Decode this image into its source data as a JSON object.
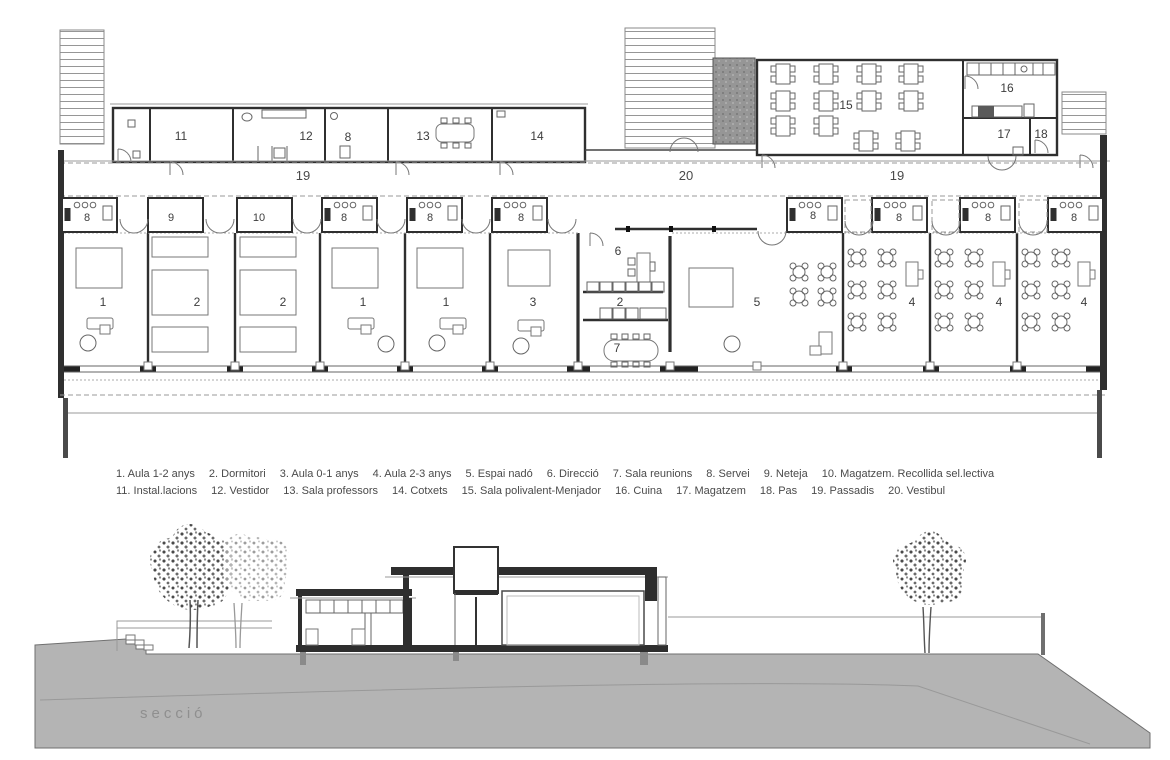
{
  "legend": {
    "row1": [
      "1. Aula 1-2 anys",
      "2. Dormitori",
      "3. Aula 0-1 anys",
      "4. Aula 2-3 anys",
      "5. Espai nadó",
      "6. Direcció",
      "7. Sala reunions",
      "8. Servei",
      "9. Neteja",
      "10. Magatzem. Recollida sel.lectiva"
    ],
    "row2": [
      "11. Instal.lacions",
      "12. Vestidor",
      "13. Sala professors",
      "14. Cotxets",
      "15. Sala polivalent-Menjador",
      "16. Cuina",
      "17. Magatzem",
      "18. Pas",
      "19. Passadis",
      "20. Vestibul"
    ]
  },
  "plan": {
    "room_labels": [
      {
        "text": "11",
        "x": 181,
        "y": 140
      },
      {
        "text": "12",
        "x": 306,
        "y": 140
      },
      {
        "text": "8",
        "x": 348,
        "y": 141
      },
      {
        "text": "13",
        "x": 423,
        "y": 140
      },
      {
        "text": "14",
        "x": 537,
        "y": 140
      },
      {
        "text": "15",
        "x": 846,
        "y": 109
      },
      {
        "text": "16",
        "x": 1007,
        "y": 92
      },
      {
        "text": "17",
        "x": 1004,
        "y": 138
      },
      {
        "text": "18",
        "x": 1041,
        "y": 138
      },
      {
        "text": "1",
        "x": 103,
        "y": 306
      },
      {
        "text": "2",
        "x": 197,
        "y": 306
      },
      {
        "text": "2",
        "x": 283,
        "y": 306
      },
      {
        "text": "1",
        "x": 363,
        "y": 306
      },
      {
        "text": "1",
        "x": 446,
        "y": 306
      },
      {
        "text": "3",
        "x": 533,
        "y": 306
      },
      {
        "text": "6",
        "x": 618,
        "y": 255
      },
      {
        "text": "2",
        "x": 620,
        "y": 306
      },
      {
        "text": "7",
        "x": 617,
        "y": 352
      },
      {
        "text": "5",
        "x": 757,
        "y": 306
      },
      {
        "text": "4",
        "x": 912,
        "y": 306
      },
      {
        "text": "4",
        "x": 999,
        "y": 306
      },
      {
        "text": "4",
        "x": 1084,
        "y": 306
      }
    ],
    "small_room_labels": [
      {
        "text": "8",
        "x": 87,
        "y": 221
      },
      {
        "text": "9",
        "x": 171,
        "y": 221
      },
      {
        "text": "10",
        "x": 259,
        "y": 221
      },
      {
        "text": "8",
        "x": 344,
        "y": 221
      },
      {
        "text": "8",
        "x": 430,
        "y": 221
      },
      {
        "text": "8",
        "x": 521,
        "y": 221
      },
      {
        "text": "8",
        "x": 813,
        "y": 219
      },
      {
        "text": "8",
        "x": 899,
        "y": 221
      },
      {
        "text": "8",
        "x": 988,
        "y": 221
      },
      {
        "text": "8",
        "x": 1074,
        "y": 221
      }
    ],
    "corridor_labels": [
      {
        "text": "19",
        "x": 303,
        "y": 180
      },
      {
        "text": "20",
        "x": 686,
        "y": 180
      },
      {
        "text": "19",
        "x": 897,
        "y": 180
      }
    ]
  },
  "section": {
    "label": "secció"
  },
  "colors": {
    "ink": "#2f2f2f",
    "light_ink": "#8f8f8f",
    "ground_gray": "#b4b4b4",
    "porch_gray": "#969696",
    "legend_text": "#4a4a4a"
  }
}
